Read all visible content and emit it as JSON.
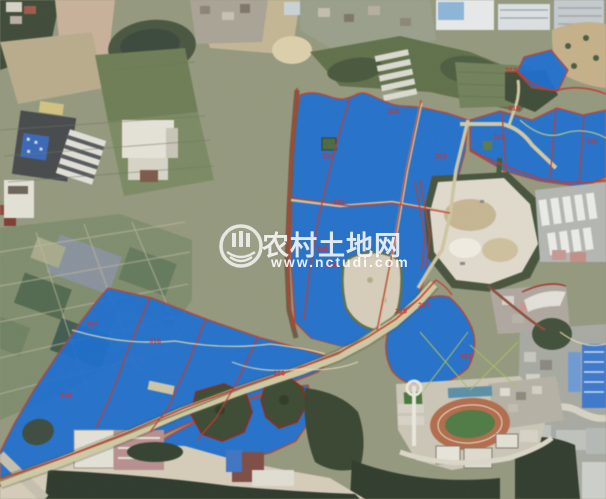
{
  "watermark": {
    "site_name": "农村土地网",
    "site_url": "www.nctudi.com",
    "logo": "nctudi-globe-logo"
  },
  "map": {
    "kind": "satellite-imagery-with-land-parcel-overlay",
    "overlay_color": "#1c6dce",
    "boundary_color": "#bf3a28",
    "island_outline_color": "#8a2618",
    "label_color": "#cf3434"
  },
  "parcel_labels": [
    {
      "text": "336",
      "x": 393,
      "y": 112
    },
    {
      "text": "315",
      "x": 328,
      "y": 157
    },
    {
      "text": "316",
      "x": 441,
      "y": 157
    },
    {
      "text": "318",
      "x": 514,
      "y": 109
    },
    {
      "text": "319",
      "x": 499,
      "y": 138
    },
    {
      "text": "312",
      "x": 511,
      "y": 71
    },
    {
      "text": "311",
      "x": 592,
      "y": 142
    },
    {
      "text": "335",
      "x": 339,
      "y": 203
    },
    {
      "text": "317",
      "x": 92,
      "y": 325
    },
    {
      "text": "316",
      "x": 155,
      "y": 342
    },
    {
      "text": "318",
      "x": 66,
      "y": 396
    },
    {
      "text": "326",
      "x": 279,
      "y": 374
    },
    {
      "text": "308",
      "x": 331,
      "y": 266
    },
    {
      "text": "325",
      "x": 401,
      "y": 312
    },
    {
      "text": "321",
      "x": 466,
      "y": 357
    },
    {
      "text": "307",
      "x": 424,
      "y": 306
    },
    {
      "text": "305",
      "x": 322,
      "y": 250
    }
  ]
}
